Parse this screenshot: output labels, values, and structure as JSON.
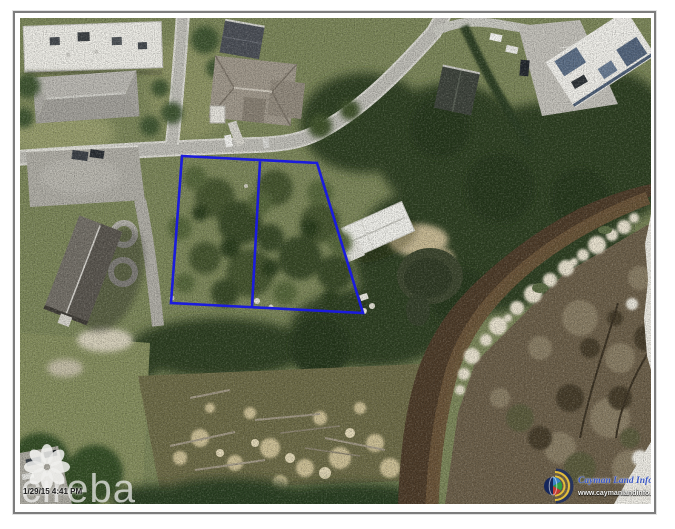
{
  "photo": {
    "description": "Aerial photograph of two adjoining vacant land parcels outlined in blue beside a road, houses and a mangrove creek",
    "parcel": {
      "outline_color": "#1b1bdd",
      "lot_count": "2"
    }
  },
  "watermarks": {
    "mls_wordmark": "cireba",
    "timestamp": "1/29/15 4:41 PM",
    "provider": {
      "name": "Cayman Land Info",
      "url": "www.caymanlandinfo.ky",
      "name_color": "#3a57c4"
    }
  }
}
